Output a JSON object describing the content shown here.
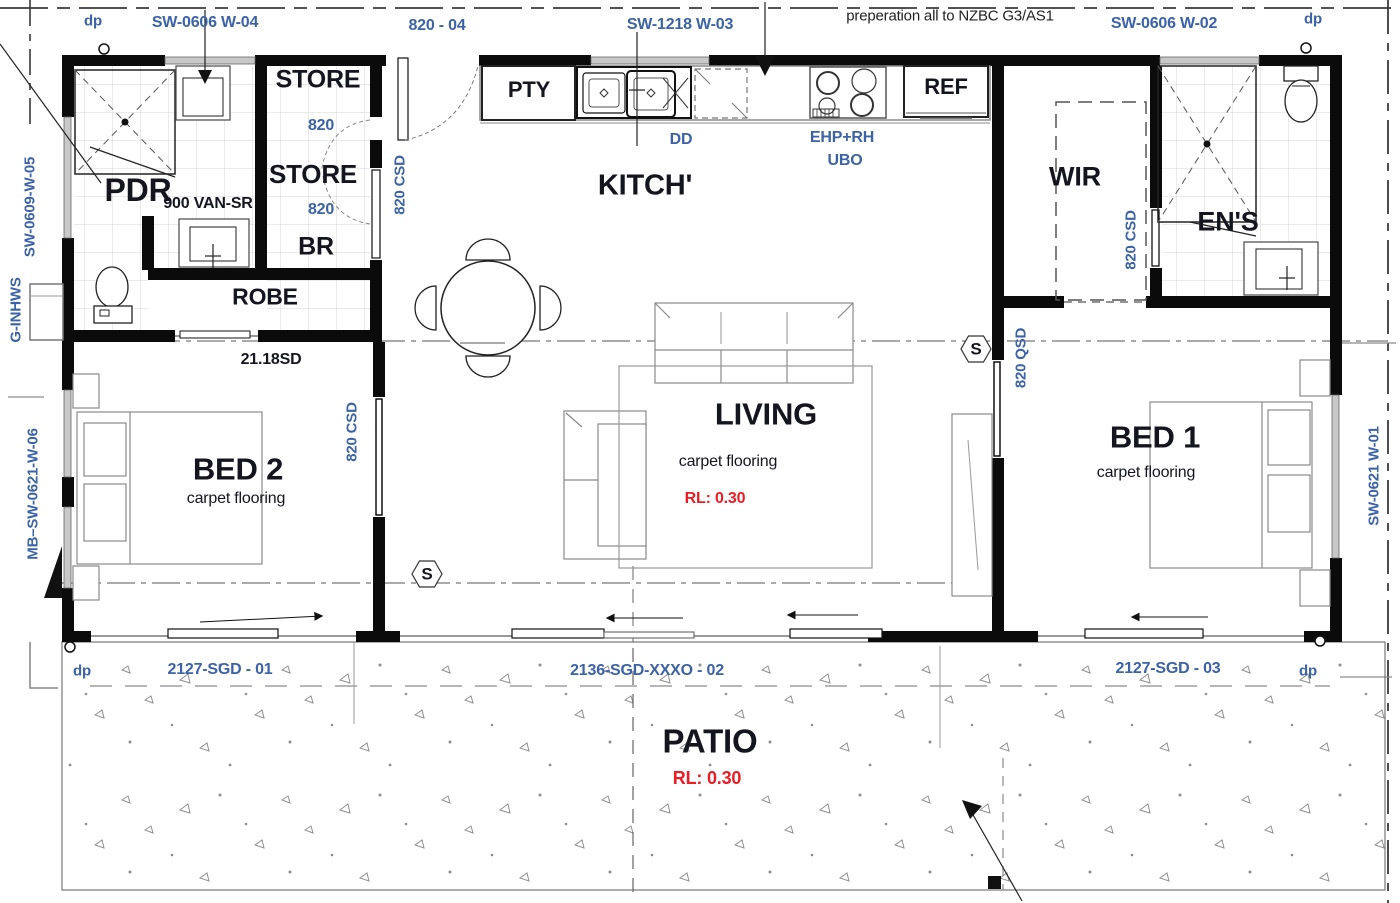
{
  "colors": {
    "code": "#3c62a8",
    "room": "#15151f",
    "note": "#222222",
    "red": "#ec1c24",
    "wall": "#0b0b0b",
    "window": "#c8c8c8",
    "tile_grid": "#d5d5d5",
    "speckle": "#8f8f8f"
  },
  "labels": [
    {
      "name": "dp-top-left",
      "text": "dp",
      "x": 93,
      "y": 21,
      "size": 15,
      "color": "code",
      "bold": true
    },
    {
      "name": "window-code-w04",
      "text": "SW-0606 W-04",
      "x": 205,
      "y": 23,
      "size": 16,
      "color": "code",
      "bold": true
    },
    {
      "name": "door-code-820-04",
      "text": "820 - 04",
      "x": 437,
      "y": 26,
      "size": 16,
      "color": "code",
      "bold": true
    },
    {
      "name": "window-code-w03",
      "text": "SW-1218 W-03",
      "x": 680,
      "y": 25,
      "size": 16,
      "color": "code",
      "bold": true
    },
    {
      "name": "note-preparation",
      "text": "preperation all to NZBC G3/AS1",
      "x": 950,
      "y": 16,
      "size": 15,
      "color": "note",
      "bold": false
    },
    {
      "name": "window-code-w02",
      "text": "SW-0606 W-02",
      "x": 1164,
      "y": 24,
      "size": 16,
      "color": "code",
      "bold": true
    },
    {
      "name": "dp-top-right",
      "text": "dp",
      "x": 1313,
      "y": 19,
      "size": 15,
      "color": "code",
      "bold": true
    },
    {
      "name": "window-code-w05",
      "text": "SW-0609-W-05",
      "x": 30,
      "y": 207,
      "size": 15,
      "color": "code",
      "bold": true,
      "rot": -90
    },
    {
      "name": "label-g-inhws",
      "text": "G-INHWS",
      "x": 16,
      "y": 310,
      "size": 15,
      "color": "code",
      "bold": true,
      "rot": -90
    },
    {
      "name": "window-code-w06",
      "text": "MB–SW-0621-W-06",
      "x": 33,
      "y": 494,
      "size": 15,
      "color": "code",
      "bold": true,
      "rot": -90
    },
    {
      "name": "window-code-w01",
      "text": "SW-0621 W-01",
      "x": 1374,
      "y": 476,
      "size": 15,
      "color": "code",
      "bold": true,
      "rot": -90
    },
    {
      "name": "room-store-top",
      "text": "STORE",
      "x": 318,
      "y": 80,
      "size": 25,
      "color": "room",
      "bold": true
    },
    {
      "name": "door-820-store-top",
      "text": "820",
      "x": 321,
      "y": 126,
      "size": 16,
      "color": "code",
      "bold": true
    },
    {
      "name": "room-store",
      "text": "STORE",
      "x": 313,
      "y": 174,
      "size": 26,
      "color": "room",
      "bold": true
    },
    {
      "name": "room-pdr",
      "text": "PDR",
      "x": 138,
      "y": 190,
      "size": 32,
      "color": "room",
      "bold": true
    },
    {
      "name": "fixture-van-sr",
      "text": "900 VAN-SR",
      "x": 208,
      "y": 204,
      "size": 16,
      "color": "room",
      "bold": true
    },
    {
      "name": "door-820-store",
      "text": "820",
      "x": 321,
      "y": 210,
      "size": 16,
      "color": "code",
      "bold": true
    },
    {
      "name": "room-br",
      "text": "BR",
      "x": 316,
      "y": 247,
      "size": 25,
      "color": "room",
      "bold": true
    },
    {
      "name": "room-robe",
      "text": "ROBE",
      "x": 265,
      "y": 297,
      "size": 23,
      "color": "room",
      "bold": true
    },
    {
      "name": "room-kitchen",
      "text": "KITCH'",
      "x": 645,
      "y": 186,
      "size": 29,
      "color": "room",
      "bold": true
    },
    {
      "name": "room-pty",
      "text": "PTY",
      "x": 529,
      "y": 90,
      "size": 22,
      "color": "room",
      "bold": true
    },
    {
      "name": "label-dd",
      "text": "DD",
      "x": 681,
      "y": 140,
      "size": 16,
      "color": "code",
      "bold": true
    },
    {
      "name": "label-ehp-rh",
      "text": "EHP+RH",
      "x": 842,
      "y": 138,
      "size": 16,
      "color": "code",
      "bold": true
    },
    {
      "name": "label-ubo",
      "text": "UBO",
      "x": 845,
      "y": 161,
      "size": 16,
      "color": "code",
      "bold": true
    },
    {
      "name": "label-ref",
      "text": "REF",
      "x": 946,
      "y": 87,
      "size": 22,
      "color": "room",
      "bold": true
    },
    {
      "name": "room-wir",
      "text": "WIR",
      "x": 1075,
      "y": 177,
      "size": 27,
      "color": "room",
      "bold": true
    },
    {
      "name": "room-ens",
      "text": "EN'S",
      "x": 1228,
      "y": 222,
      "size": 27,
      "color": "room",
      "bold": true
    },
    {
      "name": "door-code-820csd-entry",
      "text": "820 CSD",
      "x": 400,
      "y": 185,
      "size": 15,
      "color": "code",
      "bold": true,
      "rot": -90
    },
    {
      "name": "door-code-820csd-ens",
      "text": "820 CSD",
      "x": 1131,
      "y": 240,
      "size": 15,
      "color": "code",
      "bold": true,
      "rot": -90
    },
    {
      "name": "door-code-2118sd",
      "text": "21.18SD",
      "x": 271,
      "y": 360,
      "size": 16,
      "color": "room",
      "bold": true
    },
    {
      "name": "door-code-820csd-bed2",
      "text": "820 CSD",
      "x": 352,
      "y": 432,
      "size": 15,
      "color": "code",
      "bold": true,
      "rot": -90
    },
    {
      "name": "door-code-820qsd",
      "text": "820 QSD",
      "x": 1021,
      "y": 358,
      "size": 15,
      "color": "code",
      "bold": true,
      "rot": -90
    },
    {
      "name": "room-living",
      "text": "LIVING",
      "x": 766,
      "y": 414,
      "size": 31,
      "color": "room",
      "bold": true
    },
    {
      "name": "living-floor",
      "text": "carpet flooring",
      "x": 728,
      "y": 462,
      "size": 16,
      "color": "room",
      "bold": false
    },
    {
      "name": "living-rl",
      "text": "RL: 0.30",
      "x": 715,
      "y": 499,
      "size": 16,
      "color": "red",
      "bold": true
    },
    {
      "name": "room-bed2",
      "text": "BED 2",
      "x": 238,
      "y": 469,
      "size": 31,
      "color": "room",
      "bold": true
    },
    {
      "name": "bed2-floor",
      "text": "carpet flooring",
      "x": 236,
      "y": 499,
      "size": 16,
      "color": "room",
      "bold": false
    },
    {
      "name": "room-bed1",
      "text": "BED 1",
      "x": 1155,
      "y": 437,
      "size": 31,
      "color": "room",
      "bold": true
    },
    {
      "name": "bed1-floor",
      "text": "carpet flooring",
      "x": 1146,
      "y": 473,
      "size": 16,
      "color": "room",
      "bold": false
    },
    {
      "name": "switch-s-hall",
      "text": "S",
      "x": 976,
      "y": 349,
      "size": 17,
      "color": "room",
      "bold": true
    },
    {
      "name": "switch-s-bed2",
      "text": "S",
      "x": 427,
      "y": 574,
      "size": 17,
      "color": "room",
      "bold": true
    },
    {
      "name": "dp-bottom-left",
      "text": "dp",
      "x": 82,
      "y": 671,
      "size": 15,
      "color": "code",
      "bold": true
    },
    {
      "name": "door-code-sgd01",
      "text": "2127-SGD - 01",
      "x": 220,
      "y": 670,
      "size": 16,
      "color": "code",
      "bold": true
    },
    {
      "name": "door-code-sgd02",
      "text": "2136-SGD-XXXO - 02",
      "x": 647,
      "y": 671,
      "size": 16,
      "color": "code",
      "bold": true
    },
    {
      "name": "door-code-sgd03",
      "text": "2127-SGD - 03",
      "x": 1168,
      "y": 669,
      "size": 16,
      "color": "code",
      "bold": true
    },
    {
      "name": "dp-bottom-right",
      "text": "dp",
      "x": 1308,
      "y": 671,
      "size": 15,
      "color": "code",
      "bold": true
    },
    {
      "name": "room-patio",
      "text": "PATIO",
      "x": 710,
      "y": 741,
      "size": 33,
      "color": "room",
      "bold": true
    },
    {
      "name": "patio-rl",
      "text": "RL: 0.30",
      "x": 707,
      "y": 778,
      "size": 18,
      "color": "red",
      "bold": true
    }
  ]
}
